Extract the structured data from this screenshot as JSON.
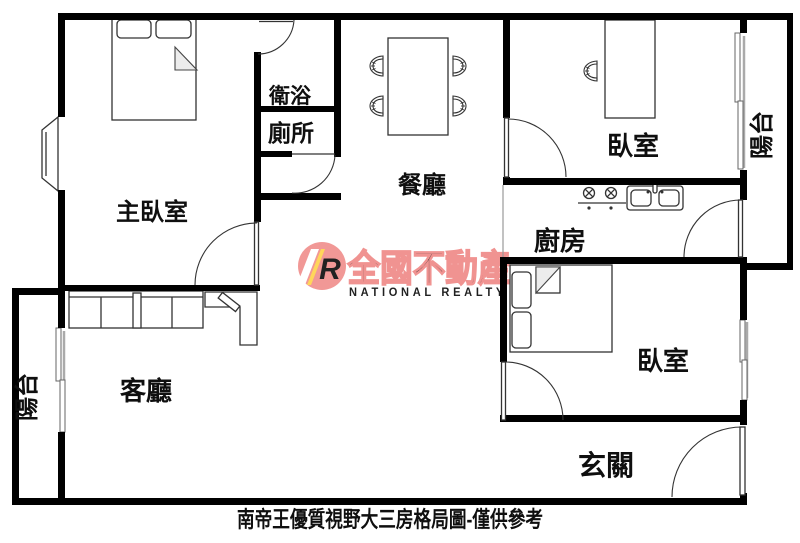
{
  "caption": "南帝王優質視野大三房格局圖-僅供參考",
  "rooms": {
    "master_bedroom": "主臥室",
    "bathroom": "衛浴",
    "toilet": "廁所",
    "dining_room": "餐廳",
    "bedroom_upper": "臥室",
    "bedroom_lower": "臥室",
    "kitchen": "廚房",
    "living_room": "客廳",
    "entry": "玄關",
    "balcony_left": "陽台",
    "balcony_right": "陽台"
  },
  "watermark": {
    "brand_zh": "全國不動產",
    "brand_en": "NATIONAL REALTY",
    "logo_letter": "R",
    "pink": "#f0908e"
  },
  "colors": {
    "wall": "#000000",
    "furniture_line": "#333333",
    "caption_text": "#3a3a3a",
    "watermark_pink": "#f0908e",
    "watermark_light_pink": "#f5aba9",
    "logo_yellow": "#ffd34d"
  }
}
